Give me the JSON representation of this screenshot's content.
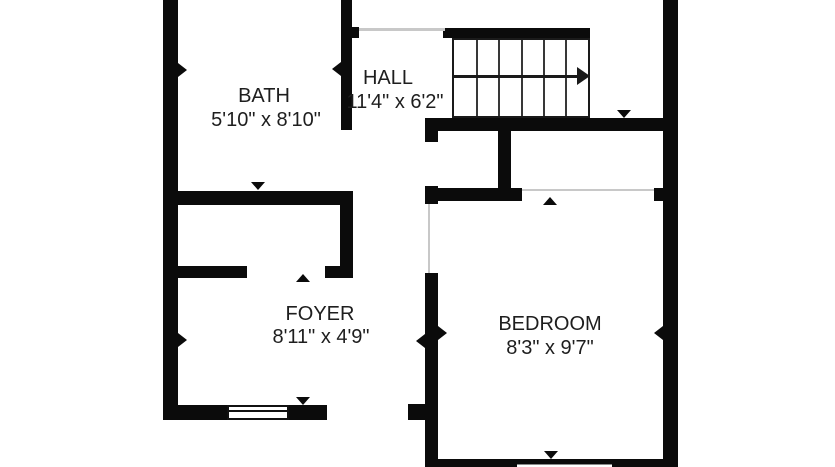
{
  "plan": {
    "type": "floor-plan",
    "background_color": "#ffffff",
    "wall_color": "#0b0b0b",
    "text_color": "#1e1e1e",
    "opening_line_color": "#c8c8c8",
    "rooms": [
      {
        "name": "BATH",
        "size": "5'10\" x 8'10\""
      },
      {
        "name": "HALL",
        "size": "11'4\" x 6'2\""
      },
      {
        "name": "FOYER",
        "size": "8'11\" x 4'9\""
      },
      {
        "name": "BEDROOM",
        "size": "8'3\" x 9'7\""
      }
    ],
    "stairs": {
      "treads": 6,
      "direction_icon": "arrow-right"
    },
    "windows": 2,
    "door_markers": 12
  }
}
